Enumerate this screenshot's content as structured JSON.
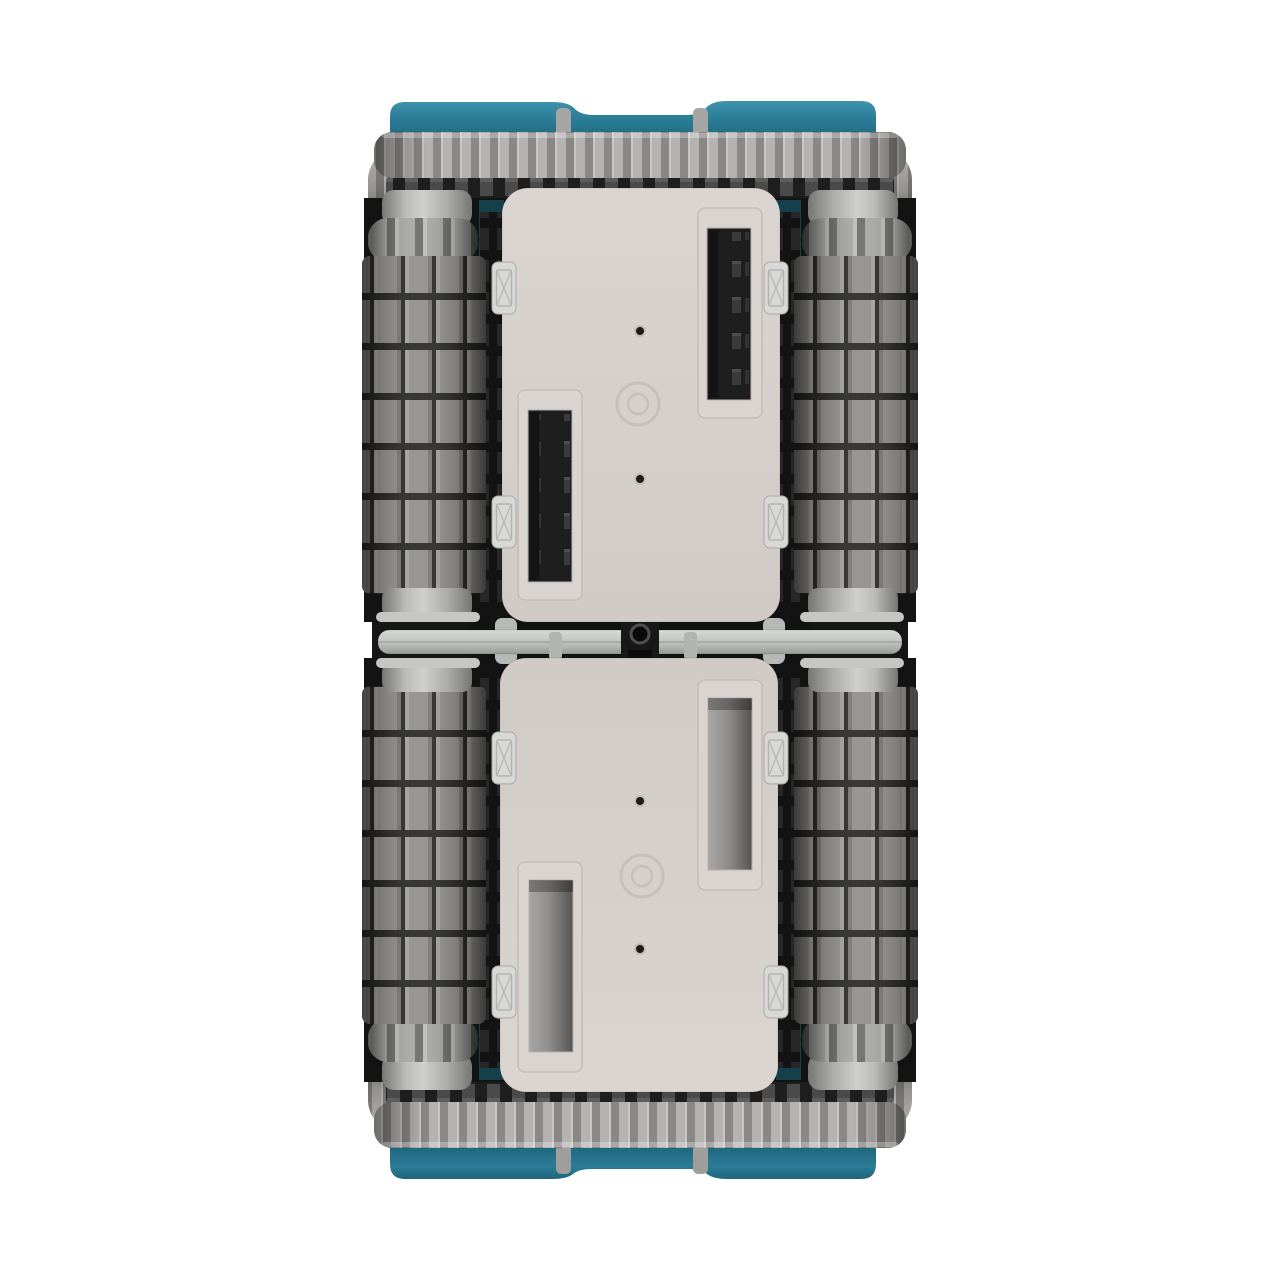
{
  "scene": {
    "view": "top-down orthographic product render on white background",
    "subject": "twin-body tracked cleaning robot with four ribbed brush rollers, two toothed tracks, teal bumper shells and a central hinge"
  },
  "colors": {
    "background": "#ffffff",
    "teal": "#2b7d97",
    "teal_highlight": "#3e93ac",
    "teal_shadow": "#1e647c",
    "teal_deep": "#174f63",
    "teal_glint": "#153f4b",
    "panel_light": "#dbd5d2",
    "panel_dark": "#d1cac7",
    "panel_trim": "#c3bcb9",
    "track_rib": "#b5b3b1",
    "track_groove": "#8a8886",
    "tooth": "#4a4a4a",
    "tooth_bg": "#1e1e1e",
    "knurl": "#a9a9a7",
    "knurl_groove": "#6f6f6d",
    "collar_light": "#d0d0ce",
    "collar_dark": "#767674",
    "roller_paddle": "#93918e",
    "paddle_gap": "#2c2c2a",
    "disc": "#c6c6c4",
    "hinge_bar_light": "#d7d9d7",
    "hinge_bar_dark": "#999b99",
    "cavity": "#161616",
    "slot_chamber_light": "#a9a7a5",
    "slot_chamber_dark": "#565452"
  },
  "parts": [
    "top-bumper",
    "bottom-bumper",
    "top-track",
    "bottom-track",
    "roller-front-left",
    "roller-front-right",
    "roller-rear-left",
    "roller-rear-right",
    "front-panel",
    "rear-panel",
    "front-panel-intake-right",
    "front-panel-intake-left",
    "rear-panel-intake-right",
    "rear-panel-intake-left",
    "panel-latch",
    "screw-hole",
    "center-boss",
    "hinge-bar",
    "hinge-lock-block",
    "hinge-pivot-hole"
  ]
}
